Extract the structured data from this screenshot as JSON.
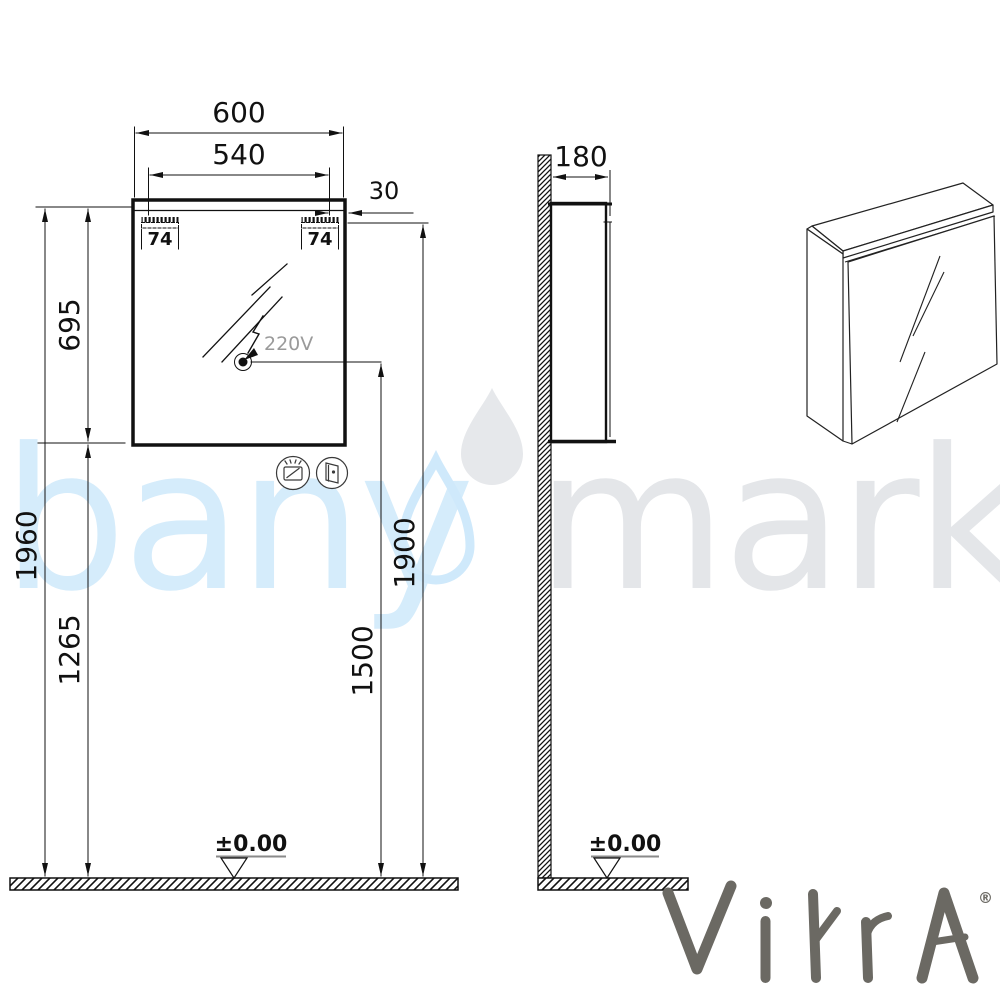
{
  "drawing": {
    "front_view": {
      "dim_total_width": "600",
      "dim_mirror_width": "540",
      "dim_top_offset": "30",
      "dim_bracket_left": "74",
      "dim_bracket_right": "74",
      "dim_cabinet_height": "695",
      "dim_total_height": "1960",
      "dim_floor_to_cabinet": "1265",
      "dim_mount_height": "1900",
      "dim_socket_height": "1500",
      "socket_label": "220V",
      "floor_level": "±0.00"
    },
    "side_view": {
      "dim_depth": "180",
      "floor_level": "±0.00"
    },
    "line_color": "#111111",
    "socket_label_color": "#9a9a9a"
  },
  "watermark": {
    "text_left": "bany",
    "text_right": "marka",
    "color_blue": "#d5ecfb",
    "color_gray": "#e4e6e9"
  },
  "brand": {
    "name": "VitrA",
    "registered": "®",
    "color": "#6b6963"
  },
  "icons": {
    "below_cabinet": [
      "defogger-icon",
      "mirror-door-icon"
    ]
  }
}
